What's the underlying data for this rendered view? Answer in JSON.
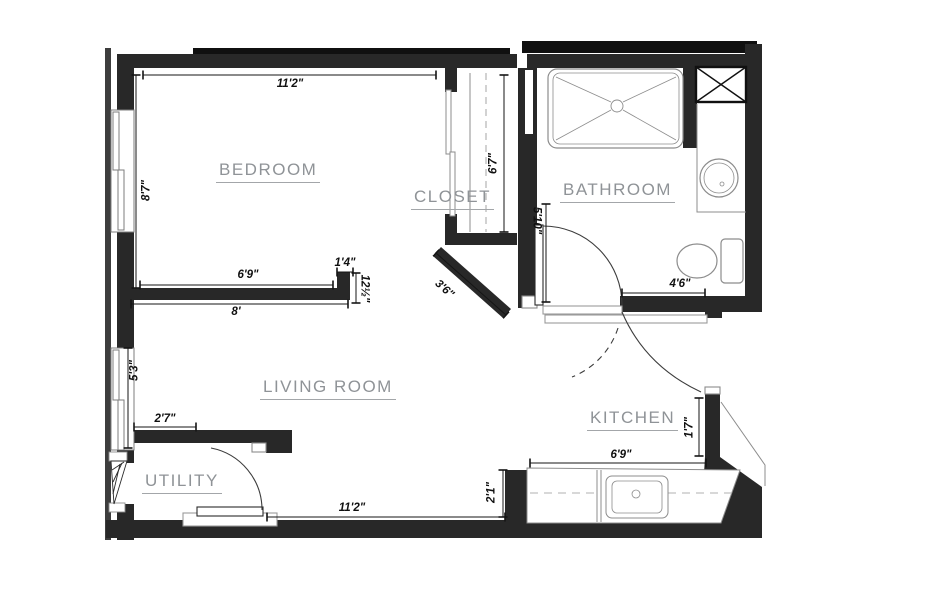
{
  "colors": {
    "wall": "#282828",
    "wall_cap": "#101010",
    "veneer": "#3d3d3d",
    "fixture_line": "#8c8c8c",
    "dimension_line": "#151515",
    "room_label": "#8f9397",
    "background": "#ffffff"
  },
  "rooms": {
    "bedroom": "BEDROOM",
    "closet": "CLOSET",
    "bathroom": "BATHROOM",
    "living": "LIVING ROOM",
    "kitchen": "KITCHEN",
    "utility": "UTILITY"
  },
  "dims": {
    "bedroom_top": "11'2\"",
    "bedroom_left": "8'7\"",
    "bedroom_bottom_inner": "6'9\"",
    "bedroom_stub_top": "1'4\"",
    "bedroom_stub_side": "12½\"",
    "bedroom_below": "8'",
    "closet_depth": "6'7\"",
    "angled_wall": "3'6\"",
    "bath_door_wall": "5'10\"",
    "bath_bottom": "4'6\"",
    "living_window": "5'3\"",
    "utility_top": "2'7\"",
    "living_bottom": "11'2\"",
    "counter_side": "2'1\"",
    "counter_top": "6'9\"",
    "kitchen_side": "1'7\""
  }
}
